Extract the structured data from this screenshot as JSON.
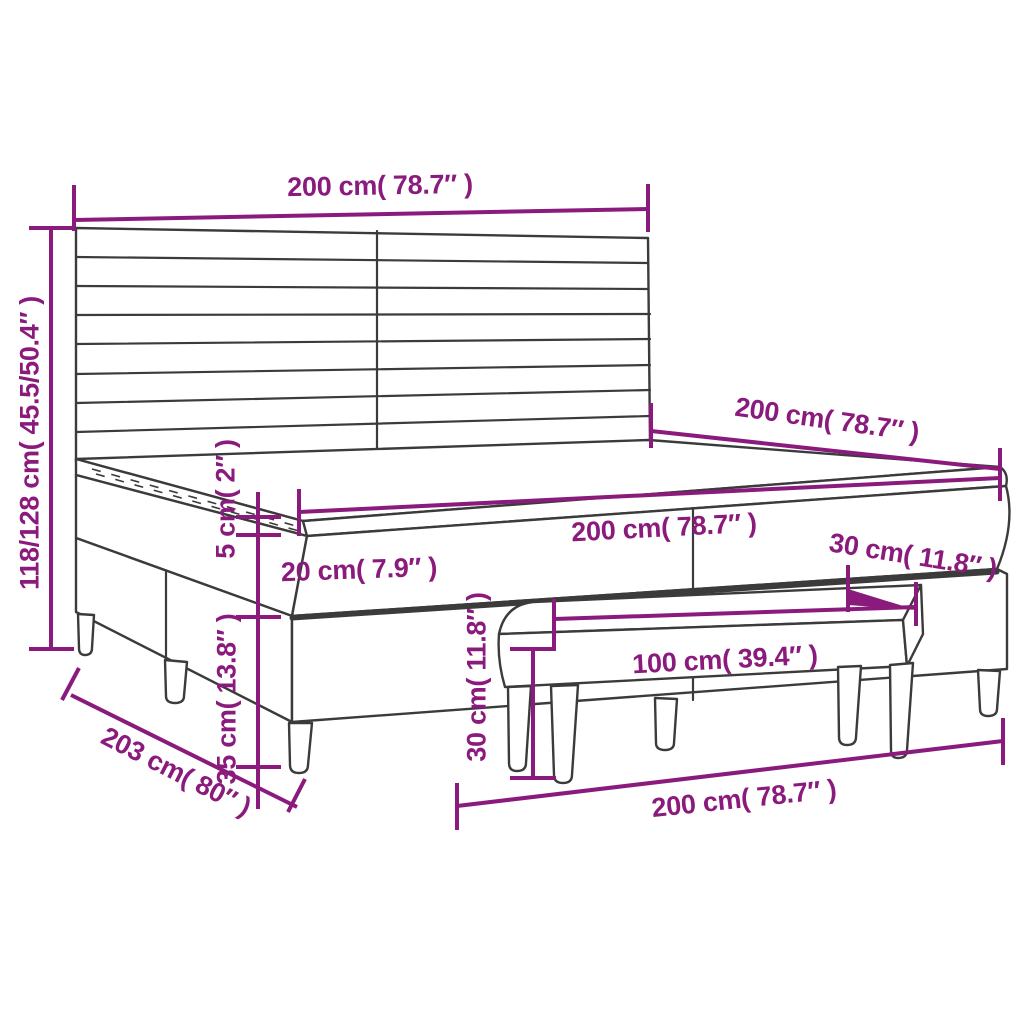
{
  "diagram": {
    "type": "product-dimension-diagram",
    "subject": "box-spring-bed-with-headboard-topper-and-bench"
  },
  "colors": {
    "dimension": "#8a1b7d",
    "furniture_line": "#3b3b3b",
    "background": "#ffffff"
  },
  "labels": {
    "headboard_width": "200 cm( 78.7″ )",
    "overall_height": "118/128 cm( 45.5/50.4″ )",
    "mattress_depth": "200 cm( 78.7″ )",
    "mattress_width": "200 cm( 78.7″ )",
    "topper_height": "5 cm( 2″ )",
    "mattress_height": "20 cm( 7.9″ )",
    "box_height": "30 cm( 11.8″ )",
    "bench_height": "30 cm( 11.8″ )",
    "leg_height": "35 cm( 13.8″ )",
    "bench_width": "100 cm( 39.4″ )",
    "frame_depth": "203 cm( 80″ )",
    "frame_width": "200 cm( 78.7″ )"
  }
}
